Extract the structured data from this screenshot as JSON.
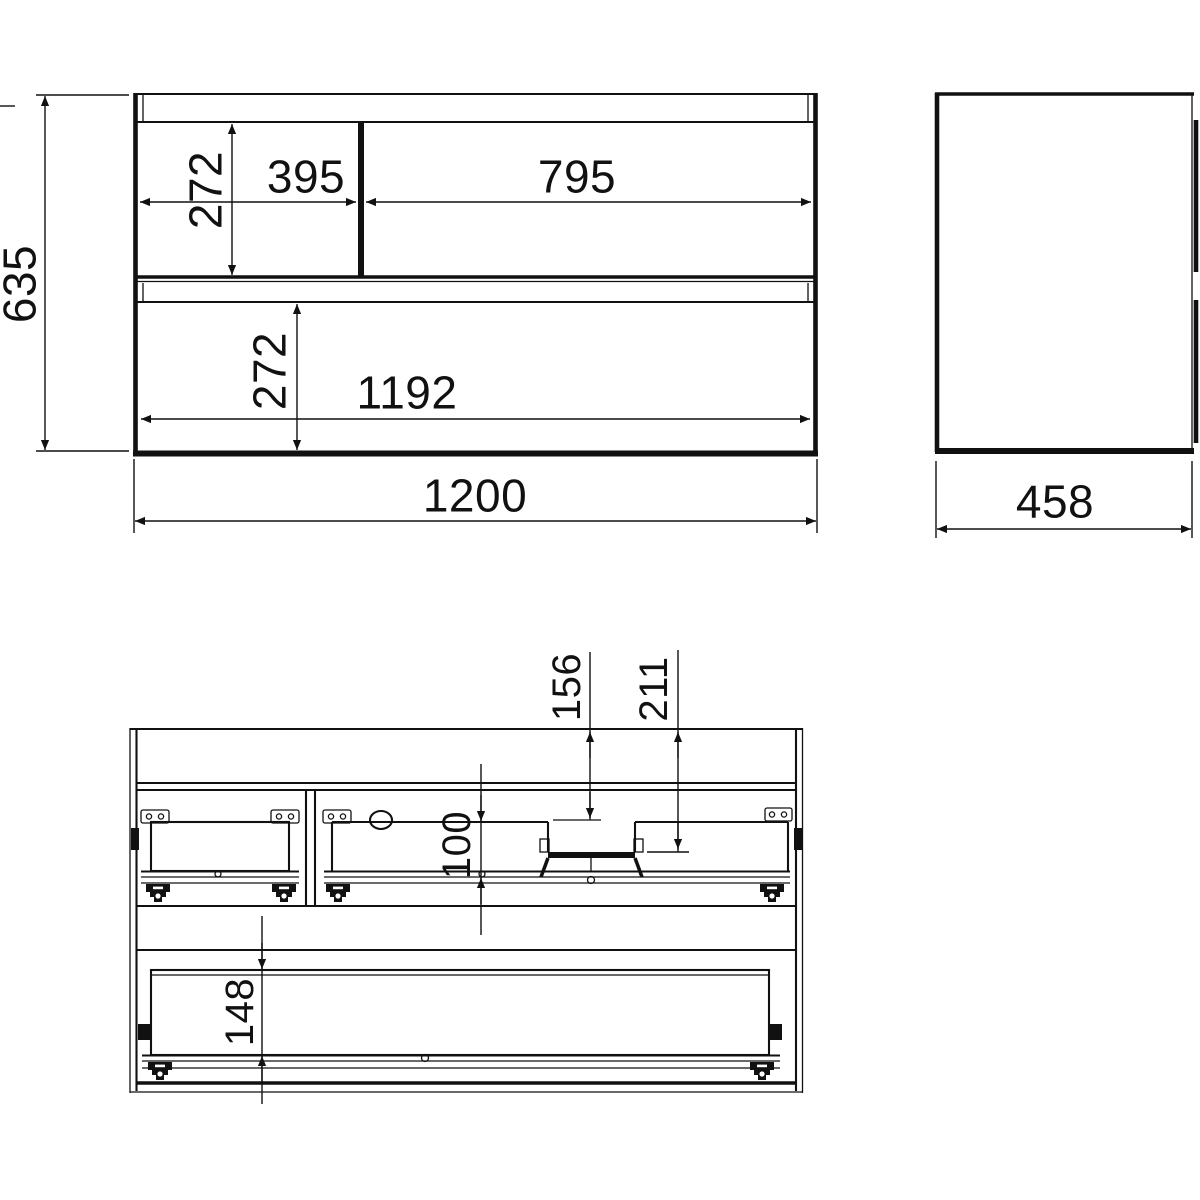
{
  "colors": {
    "line": "#111111",
    "background": "#ffffff"
  },
  "views": {
    "front": {
      "overall_height": "635",
      "overall_width": "1200",
      "inner_width": "1192",
      "left_drawer_width": "395",
      "right_drawer_width": "795",
      "top_drawer_height": "272",
      "bottom_drawer_height": "272"
    },
    "side": {
      "depth": "458"
    },
    "section": {
      "recess_offset_front": "156",
      "recess_offset_back": "211",
      "top_drawer_inner_depth": "100",
      "bottom_drawer_inner_depth": "148"
    }
  }
}
